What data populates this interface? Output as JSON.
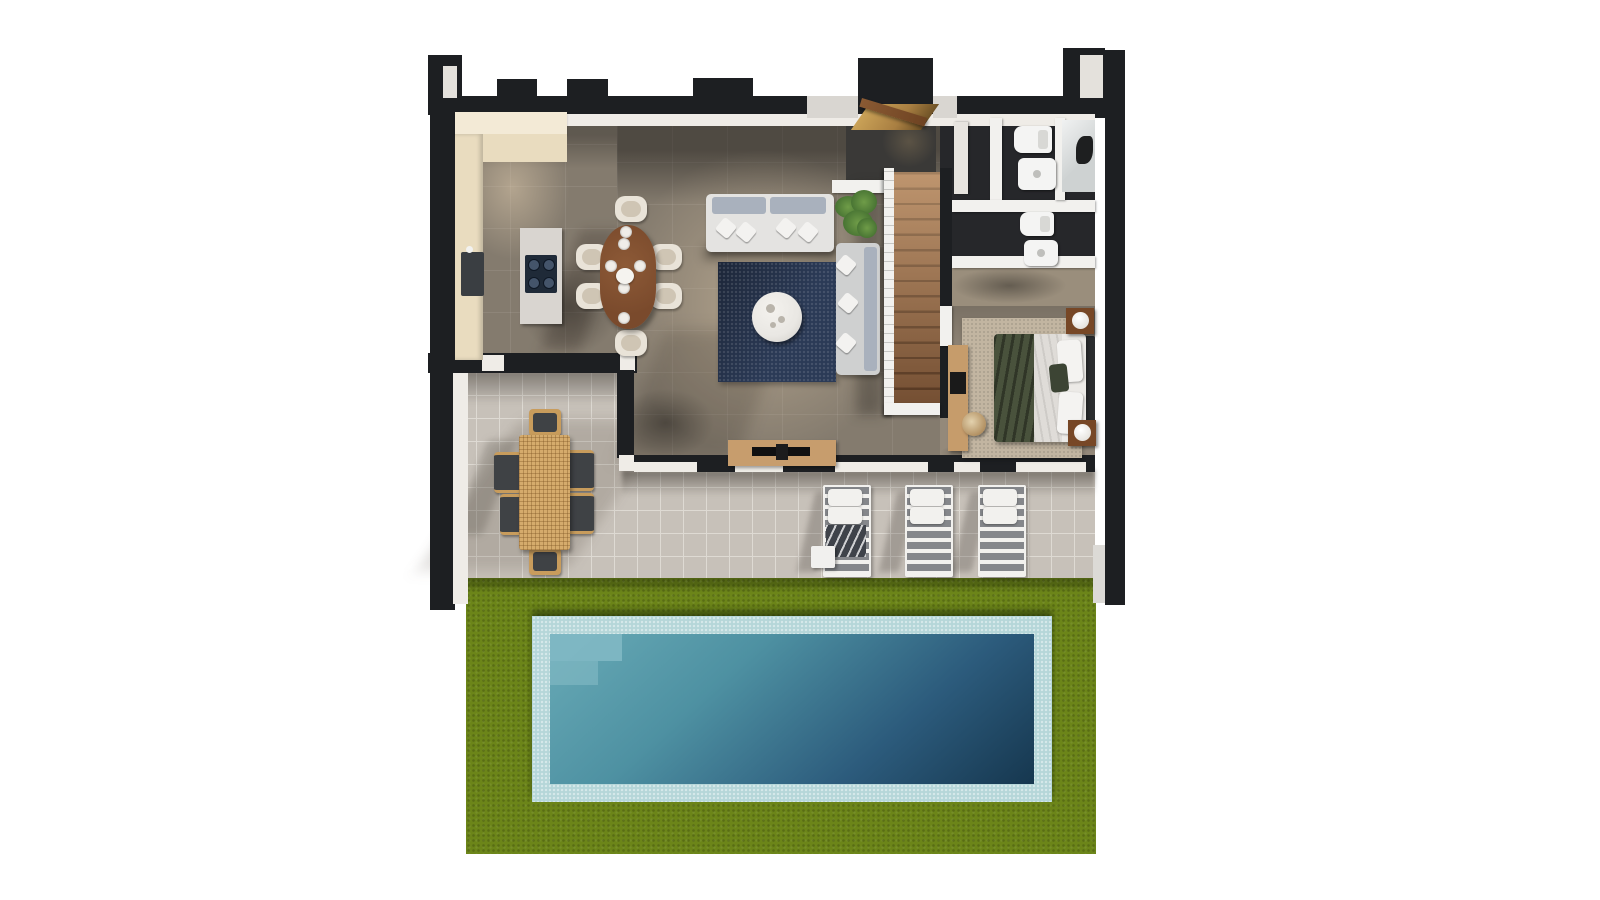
{
  "scene": {
    "type": "3d-floorplan-render",
    "view": "top-down",
    "description": "Photorealistic top-down 3D render of a single-storey villa: open-plan kitchen/dining and living room with staircase, two bathrooms with shower, bedroom, tiled terrace with outdoor dining and sun loungers, lawn with rectangular swimming pool."
  },
  "rooms": {
    "kitchen": "Kitchen",
    "dining": "Dining area",
    "living": "Living room",
    "hallway": "Entrance hall",
    "bathroom1": "Bathroom 1",
    "bathroom2": "Bathroom 2",
    "shower": "Shower",
    "corridor": "Corridor",
    "bedroom": "Bedroom",
    "stairs": "Staircase",
    "terrace": "Terrace",
    "lawn": "Lawn",
    "pool": "Swimming pool"
  },
  "furniture_counts": {
    "dining_chairs": 6,
    "dining_table": 1,
    "kitchen_island": 1,
    "sofas": 2,
    "coffee_table": 1,
    "tv_console": 1,
    "plant": 1,
    "bed": 1,
    "nightstands": 2,
    "lamps": 2,
    "desk": 1,
    "desk_chair": 1,
    "toilets": 2,
    "washbasins": 2,
    "outdoor_table": 1,
    "outdoor_chairs": 6,
    "sun_loungers": 3,
    "side_table": 1
  },
  "colors": {
    "background": "#ffffff",
    "wall": "#1d1f22",
    "wall_light_face": "#e4e1dc",
    "wall_inner_face": "#efece7",
    "stone_floor": "#847b6e",
    "kitchen_counter": "#e9dcbf",
    "kitchen_counter_light": "#f3ead6",
    "sink": "#3a3e42",
    "island": "#d9d5d0",
    "cooktop": "#1f2a38",
    "dining_table_wood": "#7a4a2c",
    "chair_cream": "#e9e3d8",
    "sofa_base": "#e4e3e1",
    "sofa_cushion": "#a9b1bd",
    "pillow_white": "#f3f2f0",
    "rug_navy": "#2b3a56",
    "coffee_table": "#e9e7e3",
    "plant_green": "#4a7634",
    "stair_wood": "#9c6a44",
    "stair_wood_dark": "#71492c",
    "railing_white": "#f2f1ee",
    "tv_console_wood": "#c79d6d",
    "tv_black": "#101011",
    "hall_floor_dark": "#3a3937",
    "bath_floor": "#26272a",
    "fixture_white": "#f4f4f3",
    "shower_glass": "#ced2d2",
    "corridor_floor": "#9a8e7c",
    "bedroom_floor": "#94897a",
    "bedroom_rug": "#c2b5a1",
    "bed_white": "#eceae7",
    "bed_throw_green": "#49523c",
    "headboard_dark": "#2c2e30",
    "nightstand_wood": "#774726",
    "desk_wood": "#c69c6b",
    "terrace_tile": "#c7c1b9",
    "terrace_grout": "#dedad3",
    "outdoor_wood": "#d5ab6c",
    "outdoor_seat_dark": "#3f4245",
    "lounger_slat_dark": "#85878b",
    "lounger_white": "#f2f1ee",
    "towel_dark": "#3f434a",
    "grass": "#6c8519",
    "pool_border_tile": "#b5d6d9",
    "pool_step": "#83bac5",
    "pool_shallow": "#68aab6",
    "pool_deep": "#16374f",
    "entry_wood": "#a97f42",
    "door_wood": "#8a5a33"
  }
}
